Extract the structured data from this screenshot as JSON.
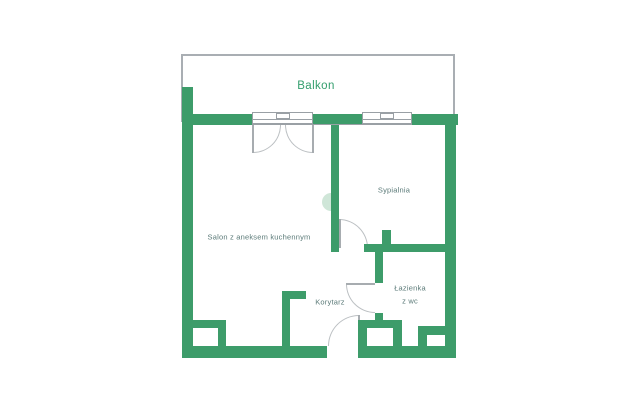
{
  "labels": {
    "balcony": "Balkon",
    "bedroom": "Sypialnia",
    "living_room": "Salon z aneksem kuchennym",
    "corridor": "Korytarz",
    "bathroom_line1": "Łazienka",
    "bathroom_line2": "z wc"
  },
  "colors": {
    "wall": "#3d9c6a",
    "balcony_border": "#a9aeb3",
    "window_border": "#9aa0a5",
    "arc": "#bcc0c3",
    "leaf": "#a7acb0",
    "door_accent": "#cfe6d8",
    "label": "#5b7a78",
    "balcony_label": "#339e6d",
    "bg": "#ffffff"
  },
  "plan": {
    "canvas": {
      "width": 640,
      "height": 412
    },
    "balcony_rect": {
      "name": "balcony-outline",
      "x": 181,
      "y": 54,
      "w": 274,
      "h": 68
    },
    "walls": [
      {
        "name": "wall-left",
        "x": 182,
        "y": 87,
        "w": 11,
        "h": 271
      },
      {
        "name": "wall-top-left",
        "x": 182,
        "y": 114,
        "w": 70,
        "h": 11
      },
      {
        "name": "wall-top-mid",
        "x": 313,
        "y": 114,
        "w": 49,
        "h": 11
      },
      {
        "name": "wall-top-right",
        "x": 412,
        "y": 114,
        "w": 46,
        "h": 11
      },
      {
        "name": "wall-right",
        "x": 445,
        "y": 114,
        "w": 11,
        "h": 244
      },
      {
        "name": "wall-bottom-left",
        "x": 182,
        "y": 346,
        "w": 145,
        "h": 12
      },
      {
        "name": "wall-bottom-right",
        "x": 358,
        "y": 346,
        "w": 98,
        "h": 12
      },
      {
        "name": "wall-bedroom-divider",
        "x": 331,
        "y": 114,
        "w": 8,
        "h": 138
      },
      {
        "name": "wall-bedroom-bottom",
        "x": 364,
        "y": 244,
        "w": 81,
        "h": 8
      },
      {
        "name": "wall-bedroom-stub",
        "x": 382,
        "y": 230,
        "w": 9,
        "h": 14
      },
      {
        "name": "wall-bathroom-upper",
        "x": 375,
        "y": 252,
        "w": 8,
        "h": 31
      },
      {
        "name": "wall-bathroom-lower",
        "x": 375,
        "y": 313,
        "w": 8,
        "h": 9
      },
      {
        "name": "wall-corridor",
        "x": 282,
        "y": 291,
        "w": 8,
        "h": 55
      },
      {
        "name": "wall-corridor-stub",
        "x": 282,
        "y": 291,
        "w": 24,
        "h": 8
      },
      {
        "name": "shaft-bottom-left-top",
        "x": 182,
        "y": 320,
        "w": 44,
        "h": 8
      },
      {
        "name": "shaft-bottom-left-right",
        "x": 218,
        "y": 320,
        "w": 8,
        "h": 27
      },
      {
        "name": "shaft-bathroom-left",
        "x": 358,
        "y": 320,
        "w": 9,
        "h": 27
      },
      {
        "name": "shaft-bathroom-top",
        "x": 358,
        "y": 320,
        "w": 44,
        "h": 8
      },
      {
        "name": "shaft-bathroom-right",
        "x": 393,
        "y": 320,
        "w": 9,
        "h": 27
      },
      {
        "name": "shaft-bottom-right-bar",
        "x": 418,
        "y": 326,
        "w": 28,
        "h": 9
      },
      {
        "name": "shaft-bottom-right-left",
        "x": 418,
        "y": 326,
        "w": 9,
        "h": 21
      }
    ],
    "windows": [
      {
        "name": "window-living-room",
        "x": 252,
        "y": 112,
        "w": 61,
        "h": 12
      },
      {
        "name": "window-bedroom",
        "x": 362,
        "y": 112,
        "w": 50,
        "h": 12
      }
    ],
    "door_arcs": [
      {
        "name": "balcony-door-arc-left",
        "x": 253,
        "y": 125,
        "w": 28,
        "h": 28,
        "corner": "br"
      },
      {
        "name": "balcony-door-arc-right",
        "x": 285,
        "y": 125,
        "w": 28,
        "h": 28,
        "corner": "bl"
      },
      {
        "name": "bedroom-door-arc",
        "x": 339,
        "y": 219,
        "w": 29,
        "h": 29,
        "corner": "tr"
      },
      {
        "name": "bathroom-door-arc",
        "x": 346,
        "y": 284,
        "w": 29,
        "h": 29,
        "corner": "bl"
      },
      {
        "name": "entrance-door-arc",
        "x": 328,
        "y": 315,
        "w": 31,
        "h": 31,
        "corner": "tl"
      }
    ],
    "door_leaves": [
      {
        "name": "balcony-door-leaf-left",
        "x": 252,
        "y": 125,
        "w": 2,
        "h": 28
      },
      {
        "name": "balcony-door-leaf-right",
        "x": 312,
        "y": 125,
        "w": 2,
        "h": 28
      },
      {
        "name": "bedroom-door-leaf",
        "x": 339,
        "y": 219,
        "w": 2,
        "h": 29
      },
      {
        "name": "bathroom-door-leaf",
        "x": 346,
        "y": 283,
        "w": 29,
        "h": 2
      },
      {
        "name": "entrance-door-leaf",
        "x": 358,
        "y": 315,
        "w": 2,
        "h": 31
      }
    ],
    "sill_line": {
      "name": "window-sill-line",
      "x": 252,
      "y": 124,
      "w": 160,
      "h": 1
    },
    "door_accent": {
      "name": "sliding-door-accent",
      "x": 322,
      "y": 193,
      "w": 9,
      "h": 18
    }
  }
}
